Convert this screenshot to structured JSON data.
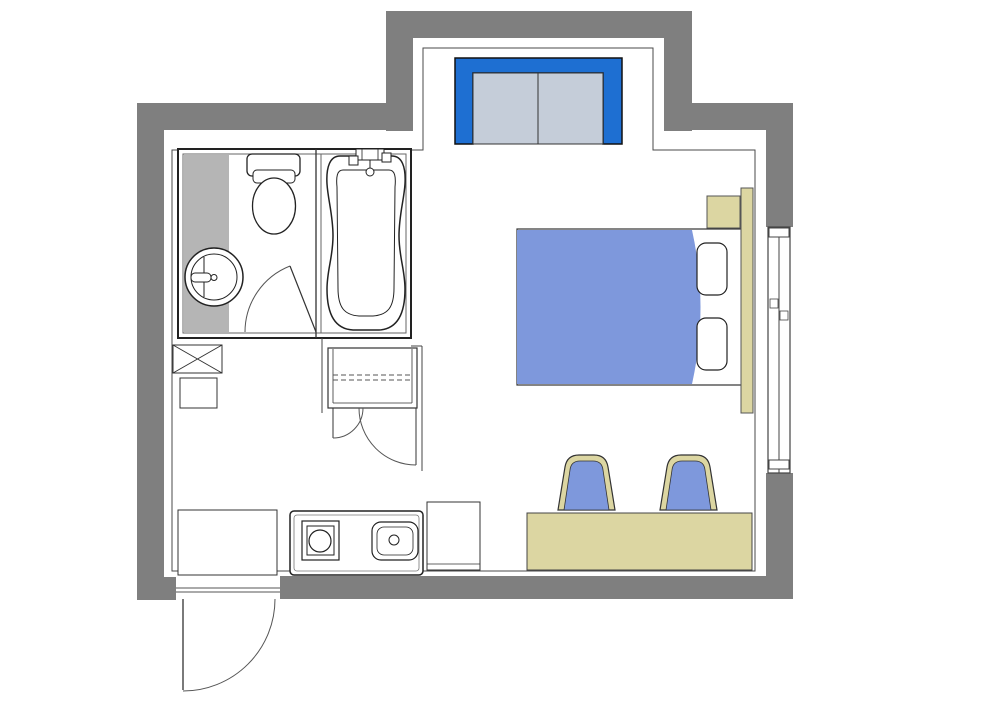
{
  "floor_plan": {
    "description": "studio-room-floor-plan",
    "palette": {
      "wall_gray": "#7f7f7f",
      "vanity_gray": "#b5b5b5",
      "accent_blue": "#1e6fd2",
      "sofa_panel_gray": "#c5cdd9",
      "soft_blue": "#7e98dc",
      "wood_tan": "#dcd6a2",
      "line_dark": "#222222",
      "line_mid": "#444444",
      "background": "#ffffff"
    },
    "walls": [
      {
        "name": "wall-left",
        "kind": "rect",
        "x": 137,
        "y": 103,
        "w": 27,
        "h": 497,
        "fill": "#7f7f7f"
      },
      {
        "name": "wall-entry-corner",
        "kind": "rect",
        "x": 137,
        "y": 577,
        "w": 39,
        "h": 23,
        "fill": "#7f7f7f"
      },
      {
        "name": "wall-top-left",
        "kind": "rect",
        "x": 137,
        "y": 103,
        "w": 276,
        "h": 27,
        "fill": "#7f7f7f"
      },
      {
        "name": "wall-alcove-left",
        "kind": "rect",
        "x": 386,
        "y": 11,
        "w": 27,
        "h": 120,
        "fill": "#7f7f7f"
      },
      {
        "name": "wall-alcove-top",
        "kind": "rect",
        "x": 386,
        "y": 11,
        "w": 306,
        "h": 27,
        "fill": "#7f7f7f"
      },
      {
        "name": "wall-alcove-right",
        "kind": "rect",
        "x": 664,
        "y": 11,
        "w": 28,
        "h": 120,
        "fill": "#7f7f7f"
      },
      {
        "name": "wall-top-right",
        "kind": "rect",
        "x": 664,
        "y": 103,
        "w": 129,
        "h": 27,
        "fill": "#7f7f7f"
      },
      {
        "name": "wall-right-upper",
        "kind": "rect",
        "x": 766,
        "y": 103,
        "w": 27,
        "h": 124,
        "fill": "#7f7f7f"
      },
      {
        "name": "wall-right-lower",
        "kind": "rect",
        "x": 766,
        "y": 473,
        "w": 27,
        "h": 126,
        "fill": "#7f7f7f"
      },
      {
        "name": "wall-bottom",
        "kind": "rect",
        "x": 280,
        "y": 576,
        "w": 513,
        "h": 23,
        "fill": "#7f7f7f"
      }
    ],
    "elements": [
      {
        "name": "interior-finish-outline",
        "kind": "path",
        "d": "M172,150 L423,150 L423,48 L653,48 L653,150 L755,150 L755,571 L172,571 Z",
        "fill": "none",
        "stroke": "#4a4a4a",
        "sw": 1
      },
      {
        "name": "window-frame",
        "kind": "rect",
        "x": 768,
        "y": 227,
        "w": 22,
        "h": 246,
        "fill": "#ffffff",
        "stroke": "#444444",
        "sw": 1.2
      },
      {
        "name": "window-center-rail",
        "kind": "line",
        "x1": 779,
        "y1": 227,
        "x2": 779,
        "y2": 473,
        "stroke": "#444444",
        "sw": 1
      },
      {
        "name": "window-cap-top",
        "kind": "rect",
        "x": 769,
        "y": 228,
        "w": 20,
        "h": 9,
        "fill": "#ffffff",
        "stroke": "#444444",
        "sw": 1
      },
      {
        "name": "window-cap-bottom",
        "kind": "rect",
        "x": 769,
        "y": 460,
        "w": 20,
        "h": 9,
        "fill": "#ffffff",
        "stroke": "#444444",
        "sw": 1
      },
      {
        "name": "window-latch-left",
        "kind": "rect",
        "x": 770,
        "y": 299,
        "w": 8,
        "h": 9,
        "fill": "#ffffff",
        "stroke": "#444444",
        "sw": 0.8
      },
      {
        "name": "window-latch-right",
        "kind": "rect",
        "x": 780,
        "y": 311,
        "w": 8,
        "h": 9,
        "fill": "#ffffff",
        "stroke": "#444444",
        "sw": 0.8
      },
      {
        "name": "bathroom-unit-outer",
        "kind": "rect",
        "x": 178,
        "y": 149,
        "w": 233,
        "h": 189,
        "fill": "#ffffff",
        "stroke": "#222222",
        "sw": 2
      },
      {
        "name": "bathroom-unit-inner",
        "kind": "rect",
        "x": 183,
        "y": 154,
        "w": 223,
        "h": 179,
        "fill": "none",
        "stroke": "#666666",
        "sw": 1
      },
      {
        "name": "vanity-counter",
        "kind": "rect",
        "x": 184,
        "y": 155,
        "w": 45,
        "h": 177,
        "fill": "#b5b5b5"
      },
      {
        "name": "bath-partition-a",
        "kind": "line",
        "x1": 316,
        "y1": 149,
        "x2": 316,
        "y2": 338,
        "stroke": "#333333",
        "sw": 1.3
      },
      {
        "name": "bath-partition-b",
        "kind": "line",
        "x1": 321,
        "y1": 154,
        "x2": 321,
        "y2": 333,
        "stroke": "#666666",
        "sw": 1
      },
      {
        "name": "toilet-tank",
        "kind": "rect",
        "x": 247,
        "y": 154,
        "w": 53,
        "h": 22,
        "rx": 5,
        "fill": "#ffffff",
        "stroke": "#222222",
        "sw": 1.3
      },
      {
        "name": "toilet-lid",
        "kind": "rect",
        "x": 253,
        "y": 170,
        "w": 42,
        "h": 13,
        "rx": 4,
        "fill": "#ffffff",
        "stroke": "#222222",
        "sw": 1
      },
      {
        "name": "toilet-bowl",
        "kind": "ellipse",
        "cx": 274,
        "cy": 206,
        "rx": 21.5,
        "ry": 28,
        "fill": "#ffffff",
        "stroke": "#222222",
        "sw": 1.3
      },
      {
        "name": "basin-outer-ring",
        "kind": "circle",
        "cx": 214,
        "cy": 277,
        "r": 29,
        "fill": "#ffffff",
        "stroke": "#222222",
        "sw": 1.5
      },
      {
        "name": "basin-inner-ring",
        "kind": "circle",
        "cx": 214,
        "cy": 277,
        "r": 23,
        "fill": "none",
        "stroke": "#222222",
        "sw": 1
      },
      {
        "name": "basin-flat-edge",
        "kind": "line",
        "x1": 204,
        "y1": 257,
        "x2": 204,
        "y2": 297,
        "stroke": "#222222",
        "sw": 1
      },
      {
        "name": "basin-faucet",
        "kind": "rect",
        "x": 191,
        "y": 273,
        "w": 20,
        "h": 9,
        "rx": 4,
        "fill": "#ffffff",
        "stroke": "#222222",
        "sw": 1
      },
      {
        "name": "basin-faucet-knob",
        "kind": "circle",
        "cx": 214,
        "cy": 277.5,
        "r": 3,
        "fill": "#ffffff",
        "stroke": "#222222",
        "sw": 1
      },
      {
        "name": "bathtub-outer",
        "kind": "path",
        "d": "M340,156 H392 C402,156 406,167 405,184 C404,200 399,215 399,236 C399,257 405,270 405,289 C405,313 398,329 379,330 H353 C334,329 327,313 327,289 C327,270 333,257 333,236 C333,215 328,200 327,184 C326,167 330,156 340,156 Z",
        "fill": "#ffffff",
        "stroke": "#222222",
        "sw": 1.5
      },
      {
        "name": "bathtub-inner",
        "kind": "path",
        "d": "M343,170 H389 C395,170 396,177 395,187 L394,288 C394,307 388,315 373,316 H359 C344,315 338,307 338,288 L337,187 C336,177 337,170 343,170 Z",
        "fill": "none",
        "stroke": "#222222",
        "sw": 1
      },
      {
        "name": "tub-faucet-body",
        "kind": "rect",
        "x": 356,
        "y": 149,
        "w": 28,
        "h": 11,
        "fill": "#ffffff",
        "stroke": "#222222",
        "sw": 1
      },
      {
        "name": "tub-faucet-grid",
        "kind": "rect",
        "x": 362,
        "y": 149,
        "w": 16,
        "h": 11,
        "fill": "none",
        "stroke": "#222222",
        "sw": 0.8
      },
      {
        "name": "tub-handle-left",
        "kind": "rect",
        "x": 349,
        "y": 156,
        "w": 9,
        "h": 9,
        "fill": "#ffffff",
        "stroke": "#222222",
        "sw": 1
      },
      {
        "name": "tub-handle-right",
        "kind": "rect",
        "x": 382,
        "y": 153,
        "w": 9,
        "h": 9,
        "fill": "#ffffff",
        "stroke": "#222222",
        "sw": 1
      },
      {
        "name": "tub-spout-stem",
        "kind": "line",
        "x1": 370,
        "y1": 160,
        "x2": 370,
        "y2": 168,
        "stroke": "#222222",
        "sw": 1
      },
      {
        "name": "tub-shower-head",
        "kind": "circle",
        "cx": 370,
        "cy": 172,
        "r": 4,
        "fill": "#ffffff",
        "stroke": "#222222",
        "sw": 1
      },
      {
        "name": "bathroom-door-arc",
        "kind": "path",
        "d": "M245,332 A71,71 0 0 1 290,266",
        "fill": "none",
        "stroke": "#555555",
        "sw": 1
      },
      {
        "name": "bathroom-door-leaf",
        "kind": "line",
        "x1": 290,
        "y1": 266,
        "x2": 316,
        "y2": 332,
        "stroke": "#333333",
        "sw": 1.2
      },
      {
        "name": "closet-niche-left",
        "kind": "line",
        "x1": 322,
        "y1": 338,
        "x2": 322,
        "y2": 413,
        "stroke": "#444444",
        "sw": 1
      },
      {
        "name": "closet-niche-top",
        "kind": "line",
        "x1": 411,
        "y1": 346,
        "x2": 422,
        "y2": 346,
        "stroke": "#444444",
        "sw": 1
      },
      {
        "name": "closet-niche-right",
        "kind": "line",
        "x1": 422,
        "y1": 346,
        "x2": 422,
        "y2": 471,
        "stroke": "#444444",
        "sw": 1
      },
      {
        "name": "closet-body",
        "kind": "rect",
        "x": 328,
        "y": 348,
        "w": 89,
        "h": 60,
        "fill": "#ffffff",
        "stroke": "#333333",
        "sw": 1.2
      },
      {
        "name": "closet-side-left",
        "kind": "line",
        "x1": 333,
        "y1": 349,
        "x2": 333,
        "y2": 403,
        "stroke": "#333333",
        "sw": 0.8
      },
      {
        "name": "closet-side-right",
        "kind": "line",
        "x1": 412,
        "y1": 349,
        "x2": 412,
        "y2": 403,
        "stroke": "#333333",
        "sw": 0.8
      },
      {
        "name": "closet-shelf-line",
        "kind": "line",
        "x1": 333,
        "y1": 403,
        "x2": 412,
        "y2": 403,
        "stroke": "#333333",
        "sw": 0.8
      },
      {
        "name": "closet-rod-dash-a",
        "kind": "line",
        "x1": 333,
        "y1": 375,
        "x2": 412,
        "y2": 375,
        "stroke": "#555555",
        "sw": 1,
        "dash": "5,3"
      },
      {
        "name": "closet-rod-dash-b",
        "kind": "line",
        "x1": 333,
        "y1": 380,
        "x2": 412,
        "y2": 380,
        "stroke": "#555555",
        "sw": 1,
        "dash": "5,3"
      },
      {
        "name": "closet-door-small-leaf",
        "kind": "line",
        "x1": 333,
        "y1": 408,
        "x2": 333,
        "y2": 438,
        "stroke": "#333333",
        "sw": 1
      },
      {
        "name": "closet-door-small-arc",
        "kind": "path",
        "d": "M333,438 A30,30 0 0 0 363,408",
        "fill": "none",
        "stroke": "#555555",
        "sw": 1
      },
      {
        "name": "closet-door-large-leaf",
        "kind": "line",
        "x1": 416,
        "y1": 408,
        "x2": 416,
        "y2": 465,
        "stroke": "#333333",
        "sw": 1
      },
      {
        "name": "closet-door-large-arc",
        "kind": "path",
        "d": "M359,408 A57,57 0 0 0 416,465",
        "fill": "none",
        "stroke": "#555555",
        "sw": 1
      },
      {
        "name": "pipe-shaft-box",
        "kind": "rect",
        "x": 173,
        "y": 345,
        "w": 49,
        "h": 28,
        "fill": "#ffffff",
        "stroke": "#333333",
        "sw": 1
      },
      {
        "name": "pipe-shaft-x1",
        "kind": "line",
        "x1": 173,
        "y1": 345,
        "x2": 222,
        "y2": 373,
        "stroke": "#333333",
        "sw": 1
      },
      {
        "name": "pipe-shaft-x2",
        "kind": "line",
        "x1": 222,
        "y1": 345,
        "x2": 173,
        "y2": 373,
        "stroke": "#333333",
        "sw": 1
      },
      {
        "name": "utility-box",
        "kind": "rect",
        "x": 180,
        "y": 378,
        "w": 37,
        "h": 30,
        "fill": "#ffffff",
        "stroke": "#333333",
        "sw": 1
      },
      {
        "name": "counter-left",
        "kind": "rect",
        "x": 178,
        "y": 510,
        "w": 99,
        "h": 65,
        "fill": "#ffffff",
        "stroke": "#333333",
        "sw": 1
      },
      {
        "name": "kitchen-unit-outer",
        "kind": "rect",
        "x": 290,
        "y": 511,
        "w": 133,
        "h": 64,
        "rx": 4,
        "fill": "#ffffff",
        "stroke": "#222222",
        "sw": 1.5
      },
      {
        "name": "kitchen-unit-inner",
        "kind": "rect",
        "x": 294,
        "y": 515,
        "w": 125,
        "h": 56,
        "rx": 3,
        "fill": "none",
        "stroke": "#777777",
        "sw": 0.8
      },
      {
        "name": "cooktop-outer",
        "kind": "rect",
        "x": 302,
        "y": 521,
        "w": 37,
        "h": 39,
        "fill": "#ffffff",
        "stroke": "#222222",
        "sw": 1.2
      },
      {
        "name": "cooktop-inner",
        "kind": "rect",
        "x": 307,
        "y": 526,
        "w": 27,
        "h": 29,
        "fill": "none",
        "stroke": "#222222",
        "sw": 1
      },
      {
        "name": "cooktop-burner",
        "kind": "circle",
        "cx": 320,
        "cy": 541,
        "r": 11,
        "fill": "#ffffff",
        "stroke": "#222222",
        "sw": 1.2
      },
      {
        "name": "kitchen-sink",
        "kind": "rect",
        "x": 372,
        "y": 522,
        "w": 46,
        "h": 38,
        "rx": 9,
        "fill": "#ffffff",
        "stroke": "#222222",
        "sw": 1.2
      },
      {
        "name": "kitchen-sink-inner",
        "kind": "rect",
        "x": 377,
        "y": 527,
        "w": 36,
        "h": 28,
        "rx": 7,
        "fill": "none",
        "stroke": "#222222",
        "sw": 0.8
      },
      {
        "name": "kitchen-sink-drain",
        "kind": "circle",
        "cx": 394,
        "cy": 540,
        "r": 5,
        "fill": "#ffffff",
        "stroke": "#222222",
        "sw": 1
      },
      {
        "name": "cabinet-right",
        "kind": "rect",
        "x": 427,
        "y": 502,
        "w": 53,
        "h": 68,
        "fill": "#ffffff",
        "stroke": "#333333",
        "sw": 1
      },
      {
        "name": "cabinet-right-line",
        "kind": "line",
        "x1": 427,
        "y1": 564,
        "x2": 480,
        "y2": 564,
        "stroke": "#333333",
        "sw": 0.8
      },
      {
        "name": "entry-threshold-a",
        "kind": "line",
        "x1": 176,
        "y1": 588,
        "x2": 280,
        "y2": 588,
        "stroke": "#555555",
        "sw": 1
      },
      {
        "name": "entry-threshold-b",
        "kind": "line",
        "x1": 176,
        "y1": 592,
        "x2": 280,
        "y2": 592,
        "stroke": "#555555",
        "sw": 1
      },
      {
        "name": "entry-door-leaf",
        "kind": "line",
        "x1": 183,
        "y1": 599,
        "x2": 183,
        "y2": 690,
        "stroke": "#333333",
        "sw": 1.3
      },
      {
        "name": "entry-door-arc",
        "kind": "path",
        "d": "M275,599 A92,92 0 0 1 183,691",
        "fill": "none",
        "stroke": "#555555",
        "sw": 1
      },
      {
        "name": "sofa-back-frame",
        "kind": "path",
        "d": "M455,58 H622 V144 H603 V73 H473 V144 H455 Z",
        "fill": "#1e6fd2",
        "stroke": "#111111",
        "sw": 1.5
      },
      {
        "name": "sofa-seat-left",
        "kind": "rect",
        "x": 473,
        "y": 73,
        "w": 65,
        "h": 71,
        "fill": "#c5cdd9",
        "stroke": "#333333",
        "sw": 1
      },
      {
        "name": "sofa-seat-right",
        "kind": "rect",
        "x": 538,
        "y": 73,
        "w": 65,
        "h": 71,
        "fill": "#c5cdd9",
        "stroke": "#333333",
        "sw": 1
      },
      {
        "name": "bed-frame",
        "kind": "rect",
        "x": 517,
        "y": 229,
        "w": 225,
        "h": 156,
        "fill": "#ffffff",
        "stroke": "#333333",
        "sw": 1.2
      },
      {
        "name": "bed-duvet",
        "kind": "path",
        "d": "M517,230 L692,230 Q709,307 692,384 L517,384 Z",
        "fill": "#7e98dc",
        "stroke": "none",
        "sw": 0
      },
      {
        "name": "pillow-top",
        "kind": "rect",
        "x": 697,
        "y": 243,
        "w": 30,
        "h": 52,
        "rx": 9,
        "fill": "#ffffff",
        "stroke": "#222222",
        "sw": 1.2
      },
      {
        "name": "pillow-bottom",
        "kind": "rect",
        "x": 697,
        "y": 318,
        "w": 30,
        "h": 52,
        "rx": 9,
        "fill": "#ffffff",
        "stroke": "#222222",
        "sw": 1.2
      },
      {
        "name": "headboard",
        "kind": "rect",
        "x": 741,
        "y": 188,
        "w": 12,
        "h": 225,
        "fill": "#dcd6a2",
        "stroke": "#555555",
        "sw": 1
      },
      {
        "name": "nightstand",
        "kind": "rect",
        "x": 707,
        "y": 196,
        "w": 33,
        "h": 32,
        "fill": "#dcd6a2",
        "stroke": "#555555",
        "sw": 1
      },
      {
        "name": "desk",
        "kind": "rect",
        "x": 527,
        "y": 513,
        "w": 225,
        "h": 57,
        "fill": "#dcd6a2",
        "stroke": "#444444",
        "sw": 1
      },
      {
        "name": "chair-left-frame",
        "kind": "path",
        "d": "M558,510 L565,467 Q567,455 579,455 L594,455 Q606,455 608,467 L615,510 Z",
        "fill": "#dcd6a2",
        "stroke": "#333333",
        "sw": 1.2
      },
      {
        "name": "chair-left-seat",
        "kind": "path",
        "d": "M564,510 L570,470 Q571,461 580,461 L593,461 Q602,461 603,470 L609,510 Z",
        "fill": "#7e98dc",
        "stroke": "#333333",
        "sw": 0.8
      },
      {
        "name": "chair-right-frame",
        "kind": "path",
        "d": "M660,510 L667,467 Q669,455 681,455 L696,455 Q708,455 710,467 L717,510 Z",
        "fill": "#dcd6a2",
        "stroke": "#333333",
        "sw": 1.2
      },
      {
        "name": "chair-right-seat",
        "kind": "path",
        "d": "M666,510 L672,470 Q673,461 682,461 L695,461 Q704,461 705,470 L711,510 Z",
        "fill": "#7e98dc",
        "stroke": "#333333",
        "sw": 0.8
      }
    ]
  }
}
